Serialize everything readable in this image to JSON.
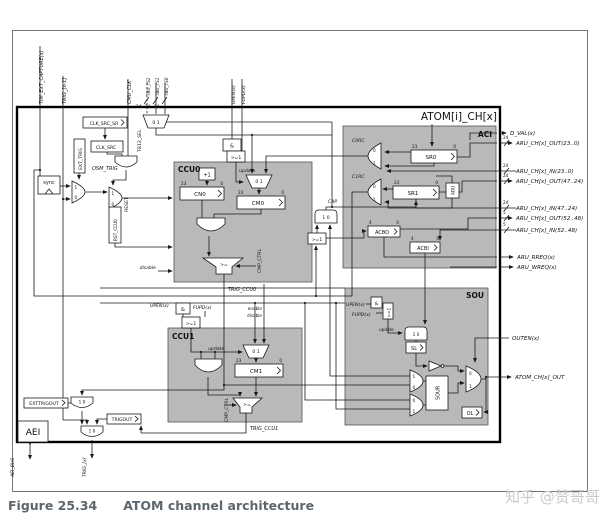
{
  "figure": {
    "caption_prefix": "Figure 25.34",
    "caption_title": "ATOM channel architecture",
    "watermark": "知乎 @赞哥哥"
  },
  "channel": {
    "title": "ATOM[i]_CH[x]"
  },
  "blocks": {
    "aci": "ACI",
    "sou": "SOU",
    "ccu0": "CCU0",
    "ccu1": "CCU1",
    "aei": "AEI"
  },
  "top_inputs": {
    "tim_ext_capture": "TIM_EXT_CAPTURE(x)",
    "trig_prev": "TRIG_[x-1]",
    "cmu_clk": "CMU_CLK",
    "tbu_ts2": "TBU_TS2",
    "tbu_ts1": "TBU_TS1",
    "tbu_ts0": "TBU_TS0",
    "upen": "UPEN(x)",
    "fupd": "FUPD(x)",
    "bus_width": "24"
  },
  "right_ports": {
    "d_val": "D_VAL(x)",
    "aru_out_23_0": "ARU_CH[x]_OUT(23..0)",
    "aru_in_23_0": "ARU_CH[x]_IN(23..0)",
    "aru_out_47_24": "ARU_CH[x]_OUT(47..24)",
    "aru_in_47_24": "ARU_CH[x]_IN(47..24)",
    "aru_out_52_48": "ARU_CH[x]_OUT(52..48)",
    "aru_in_52_48": "ARU_CH[x]_IN(52..48)",
    "aru_rreq": "ARU_RREQ(x)",
    "aru_wreq": "ARU_WREQ(x)",
    "outen": "OUTEN(x)",
    "atom_out": "ATOM_CH[x]_OUT",
    "w24": "24",
    "w5": "5"
  },
  "bottom_ports": {
    "aei_bus": "AEI_BUS",
    "trig_next": "TRIG_[x]"
  },
  "registers": {
    "clk_src_sr": "CLK_SRC_SR",
    "clk_src": "CLK_SRC",
    "ext_trig": "EXT_TRIG",
    "rst_ccu0": "RST_CCU0",
    "cn0": "CN0",
    "cm0": "CM0",
    "cm1": "CM1",
    "sr0": "SR0",
    "sr1": "SR1",
    "adu": "ADU",
    "acbo": "ACBO",
    "acbi": "ACBI",
    "sl": "SL",
    "ol": "OL",
    "sour": "SOUR",
    "exttrigout": "EXTTRIGOUT",
    "trigout": "TRIGOUT"
  },
  "gates": {
    "and": "&",
    "or": ">=1",
    "plus_one": "+1",
    "ge": ">=",
    "sync": "sync"
  },
  "labels": {
    "osm_trig": "OSM_TRIG",
    "tb12_sel": "TB12_SEL",
    "c0rc": "C0RC",
    "c1rc": "C1RC",
    "cap": "CAP",
    "cmp_ctrl": "CMP_CTRL",
    "trig_ccu0": "TRIG_CCU0",
    "trig_ccu1": "TRIG_CCU1",
    "update": "update",
    "enable": "enable",
    "disable": "disable",
    "reset": "RESET",
    "upen": "UPEN(x)",
    "fupd": "FUPD(x)"
  },
  "bits": {
    "b23": "23",
    "b0": "0",
    "b4": "4"
  },
  "mux": {
    "m01": "0 1",
    "m10": "1 0",
    "zero": "0",
    "one": "1"
  }
}
